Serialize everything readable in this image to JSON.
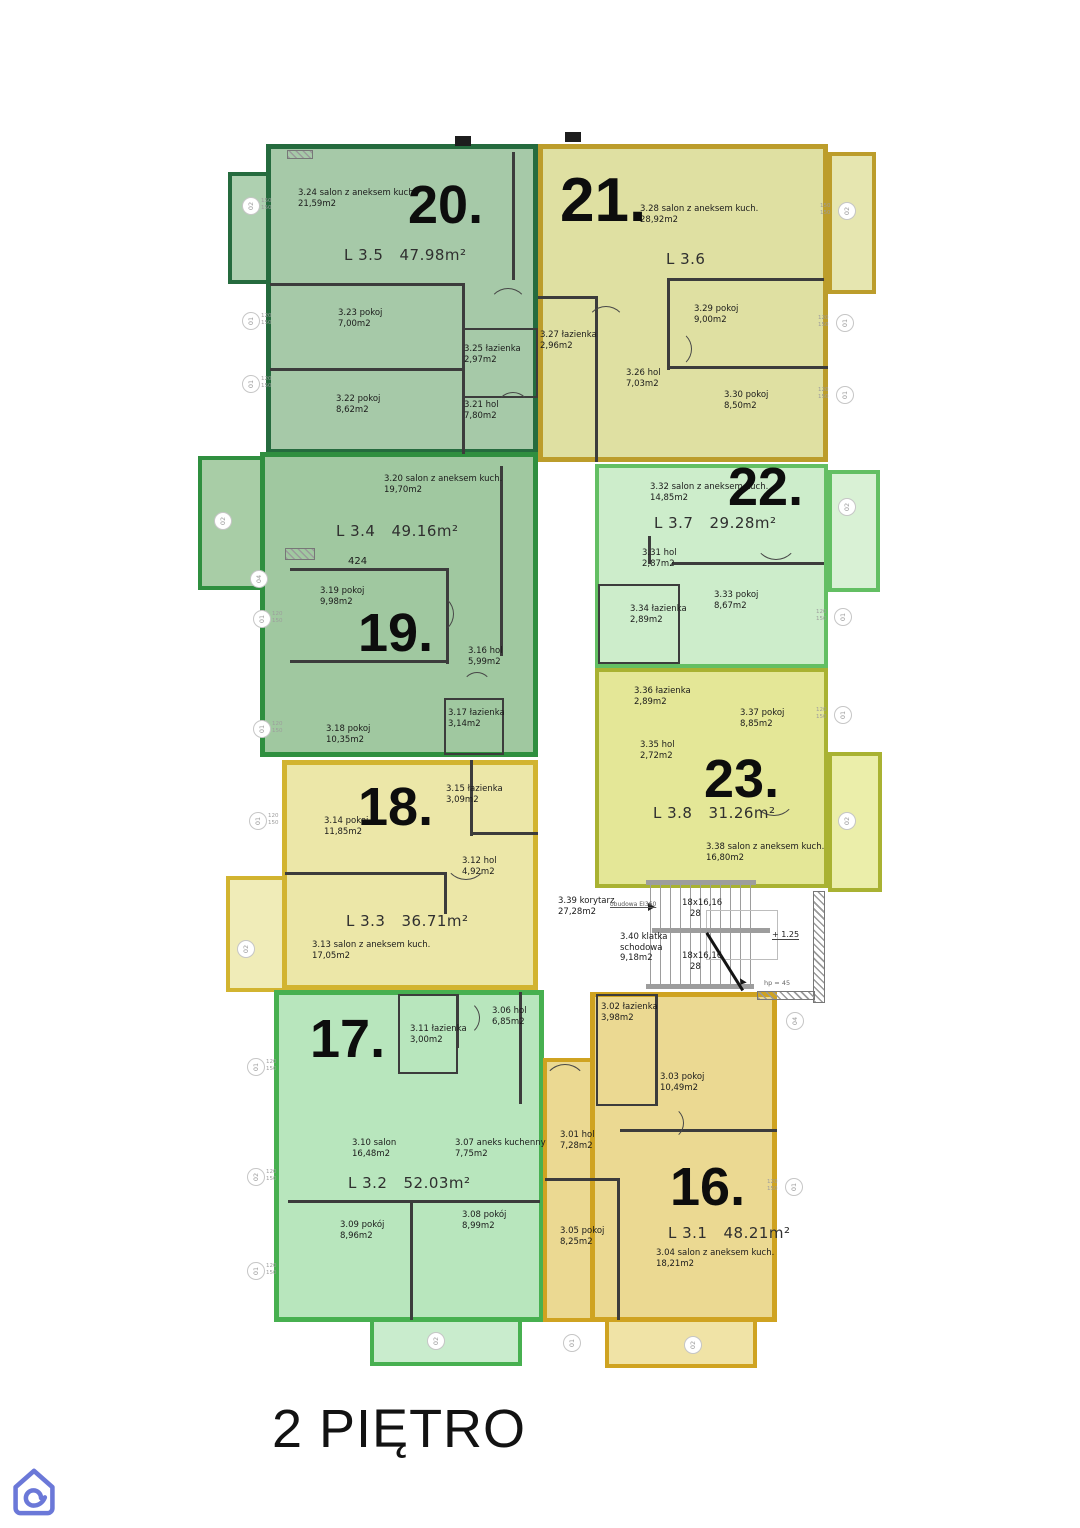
{
  "floor_title": "2 PIĘTRO",
  "apartments": [
    {
      "number": "16.",
      "unit": "L 3.1",
      "area": "48.21m²",
      "fill": "#ebd992",
      "border": "#cfa321",
      "rooms": [
        {
          "label": "3.01 hol",
          "area": "7,28m2"
        },
        {
          "label": "3.02 łazienka",
          "area": "3,98m2"
        },
        {
          "label": "3.03 pokoj",
          "area": "10,49m2"
        },
        {
          "label": "3.04 salon z aneksem kuch.",
          "area": "18,21m2"
        },
        {
          "label": "3.05 pokoj",
          "area": "8,25m2"
        }
      ]
    },
    {
      "number": "17.",
      "unit": "L 3.2",
      "area": "52.03m²",
      "fill": "#b8e6bd",
      "border": "#47b050",
      "rooms": [
        {
          "label": "3.06 hol",
          "area": "6,85m2"
        },
        {
          "label": "3.07 aneks kuchenny",
          "area": "7,75m2"
        },
        {
          "label": "3.08 pokój",
          "area": "8,99m2"
        },
        {
          "label": "3.09 pokój",
          "area": "8,96m2"
        },
        {
          "label": "3.10 salon",
          "area": "16,48m2"
        },
        {
          "label": "3.11 łazienka",
          "area": "3,00m2"
        }
      ]
    },
    {
      "number": "18.",
      "unit": "L 3.3",
      "area": "36.71m²",
      "fill": "#ece7a8",
      "border": "#d2b430",
      "rooms": [
        {
          "label": "3.12 hol",
          "area": "4,92m2"
        },
        {
          "label": "3.13 salon z aneksem kuch.",
          "area": "17,05m2"
        },
        {
          "label": "3.14 pokoj",
          "area": "11,85m2"
        },
        {
          "label": "3.15 łazienka",
          "area": "3,09m2"
        }
      ]
    },
    {
      "number": "19.",
      "unit": "L 3.4",
      "area": "49.16m²",
      "fill": "#a0c8a0",
      "border": "#2f8f3f",
      "rooms": [
        {
          "label": "3.16 hol",
          "area": "5,99m2"
        },
        {
          "label": "3.17 łazienka",
          "area": "3,14m2"
        },
        {
          "label": "3.18 pokoj",
          "area": "10,35m2"
        },
        {
          "label": "3.19 pokoj",
          "area": "9,98m2"
        },
        {
          "label": "3.20 salon z aneksem kuch.",
          "area": "19,70m2"
        }
      ]
    },
    {
      "number": "20.",
      "unit": "L 3.5",
      "area": "47.98m²",
      "fill": "#a6c9a8",
      "border": "#256b3e",
      "rooms": [
        {
          "label": "3.21 hol",
          "area": "7,80m2"
        },
        {
          "label": "3.22 pokoj",
          "area": "8,62m2"
        },
        {
          "label": "3.23 pokoj",
          "area": "7,00m2"
        },
        {
          "label": "3.24 salon z aneksem kuch.",
          "area": "21,59m2"
        },
        {
          "label": "3.25 łazienka",
          "area": "2,97m2"
        }
      ]
    },
    {
      "number": "21.",
      "unit": "L 3.6",
      "area": "",
      "fill": "#dfe0a2",
      "border": "#bc9d2b",
      "rooms": [
        {
          "label": "3.26 hol",
          "area": "7,03m2"
        },
        {
          "label": "3.27 łazienka",
          "area": "2,96m2"
        },
        {
          "label": "3.28 salon z aneksem kuch.",
          "area": "28,92m2"
        },
        {
          "label": "3.29 pokoj",
          "area": "9,00m2"
        },
        {
          "label": "3.30 pokoj",
          "area": "8,50m2"
        }
      ]
    },
    {
      "number": "22.",
      "unit": "L 3.7",
      "area": "29.28m²",
      "fill": "#cdedcb",
      "border": "#63bf63",
      "rooms": [
        {
          "label": "3.31 hol",
          "area": "2,87m2"
        },
        {
          "label": "3.32 salon z aneksem kuch.",
          "area": "14,85m2"
        },
        {
          "label": "3.33 pokoj",
          "area": "8,67m2"
        },
        {
          "label": "3.34 łazienka",
          "area": "2,89m2"
        }
      ]
    },
    {
      "number": "23.",
      "unit": "L 3.8",
      "area": "31.26m²",
      "fill": "#e4e797",
      "border": "#a9b232",
      "rooms": [
        {
          "label": "3.35 hol",
          "area": "2,72m2"
        },
        {
          "label": "3.36 łazienka",
          "area": "2,89m2"
        },
        {
          "label": "3.37 pokoj",
          "area": "8,85m2"
        },
        {
          "label": "3.38 salon z aneksem kuch.",
          "area": "16,80m2"
        }
      ]
    }
  ],
  "corridor": {
    "label": "3.39 korytarz",
    "area": "27,28m2"
  },
  "staircase": {
    "line1": "3.40 klatka",
    "line2": "schodowa",
    "area": "9,18m2"
  },
  "stairs": {
    "flight_upper": "18x16,16",
    "flight_upper_risers": "28",
    "flight_lower": "18x16,16",
    "flight_lower_risers": "28"
  },
  "annotations": {
    "corridor_note": "obudowa EI360",
    "level_mark": "+ 1.25",
    "handrail_note": "hp = 45",
    "dim_note": "424"
  },
  "markers": [
    {
      "x": 250,
      "y": 205,
      "label": "02",
      "dims": [
        "150",
        "150"
      ]
    },
    {
      "x": 250,
      "y": 320,
      "label": "01",
      "dims": [
        "120",
        "150"
      ]
    },
    {
      "x": 250,
      "y": 383,
      "label": "01",
      "dims": [
        "120",
        "150"
      ]
    },
    {
      "x": 222,
      "y": 520,
      "label": "02",
      "dims": []
    },
    {
      "x": 258,
      "y": 578,
      "label": "04",
      "dims": []
    },
    {
      "x": 261,
      "y": 618,
      "label": "01",
      "dims": [
        "120",
        "150"
      ]
    },
    {
      "x": 261,
      "y": 728,
      "label": "01",
      "dims": [
        "120",
        "150"
      ]
    },
    {
      "x": 257,
      "y": 820,
      "label": "01",
      "dims": [
        "120",
        "150"
      ]
    },
    {
      "x": 245,
      "y": 948,
      "label": "02",
      "dims": []
    },
    {
      "x": 255,
      "y": 1066,
      "label": "01",
      "dims": [
        "120",
        "150"
      ]
    },
    {
      "x": 255,
      "y": 1176,
      "label": "02",
      "dims": [
        "120",
        "150"
      ]
    },
    {
      "x": 255,
      "y": 1270,
      "label": "01",
      "dims": [
        "120",
        "150"
      ]
    },
    {
      "x": 846,
      "y": 210,
      "label": "02",
      "dims": [
        "150",
        "150"
      ]
    },
    {
      "x": 844,
      "y": 322,
      "label": "01",
      "dims": [
        "120",
        "150"
      ]
    },
    {
      "x": 844,
      "y": 394,
      "label": "01",
      "dims": [
        "120",
        "150"
      ]
    },
    {
      "x": 846,
      "y": 506,
      "label": "02",
      "dims": []
    },
    {
      "x": 842,
      "y": 616,
      "label": "01",
      "dims": [
        "120",
        "150"
      ]
    },
    {
      "x": 842,
      "y": 714,
      "label": "01",
      "dims": [
        "120",
        "150"
      ]
    },
    {
      "x": 846,
      "y": 820,
      "label": "02",
      "dims": []
    },
    {
      "x": 794,
      "y": 1020,
      "label": "04",
      "dims": []
    },
    {
      "x": 793,
      "y": 1186,
      "label": "01",
      "dims": [
        "120",
        "150"
      ]
    },
    {
      "x": 435,
      "y": 1340,
      "label": "02",
      "dims": []
    },
    {
      "x": 571,
      "y": 1342,
      "label": "01",
      "dims": []
    },
    {
      "x": 692,
      "y": 1344,
      "label": "02",
      "dims": []
    }
  ],
  "logo_color": "#6b78d8"
}
